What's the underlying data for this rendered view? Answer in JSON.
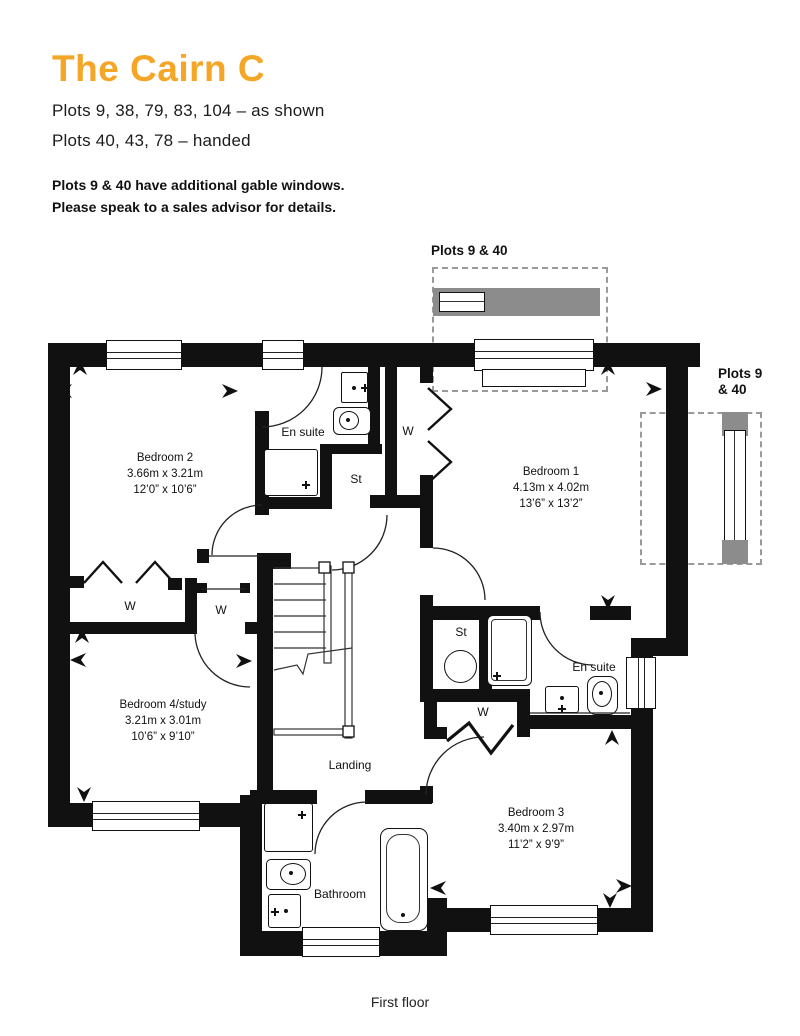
{
  "header": {
    "title": "The Cairn C",
    "plots_line1": "Plots 9, 38, 79, 83, 104 – as shown",
    "plots_line2": "Plots 40, 43, 78 – handed",
    "note_line1": "Plots 9 & 40 have additional gable windows.",
    "note_line2": "Please speak to a sales advisor for details."
  },
  "callouts": {
    "top": "Plots 9 & 40",
    "right_line1": "Plots 9",
    "right_line2": "& 40"
  },
  "rooms": {
    "bedroom2": {
      "name": "Bedroom 2",
      "metric": "3.66m x 3.21m",
      "imperial": "12’0” x 10’6”"
    },
    "bedroom1": {
      "name": "Bedroom 1",
      "metric": "4.13m x 4.02m",
      "imperial": "13’6” x 13’2”"
    },
    "bedroom4": {
      "name": "Bedroom 4/study",
      "metric": "3.21m x 3.01m",
      "imperial": "10’6” x 9’10”"
    },
    "bedroom3": {
      "name": "Bedroom 3",
      "metric": "3.40m x 2.97m",
      "imperial": "11’2” x 9’9”"
    },
    "ensuite_top": "En suite",
    "ensuite_bottom": "En suite",
    "bathroom": "Bathroom",
    "landing": "Landing",
    "store_top": "St",
    "store_bottom": "St",
    "wardrobe_top": "W",
    "wardrobe_left": "W",
    "wardrobe_mid": "W",
    "wardrobe_bottom": "W"
  },
  "caption": "First floor",
  "colors": {
    "accent": "#F5A626",
    "wall": "#111111",
    "gable_gray": "#8C8C8C"
  }
}
